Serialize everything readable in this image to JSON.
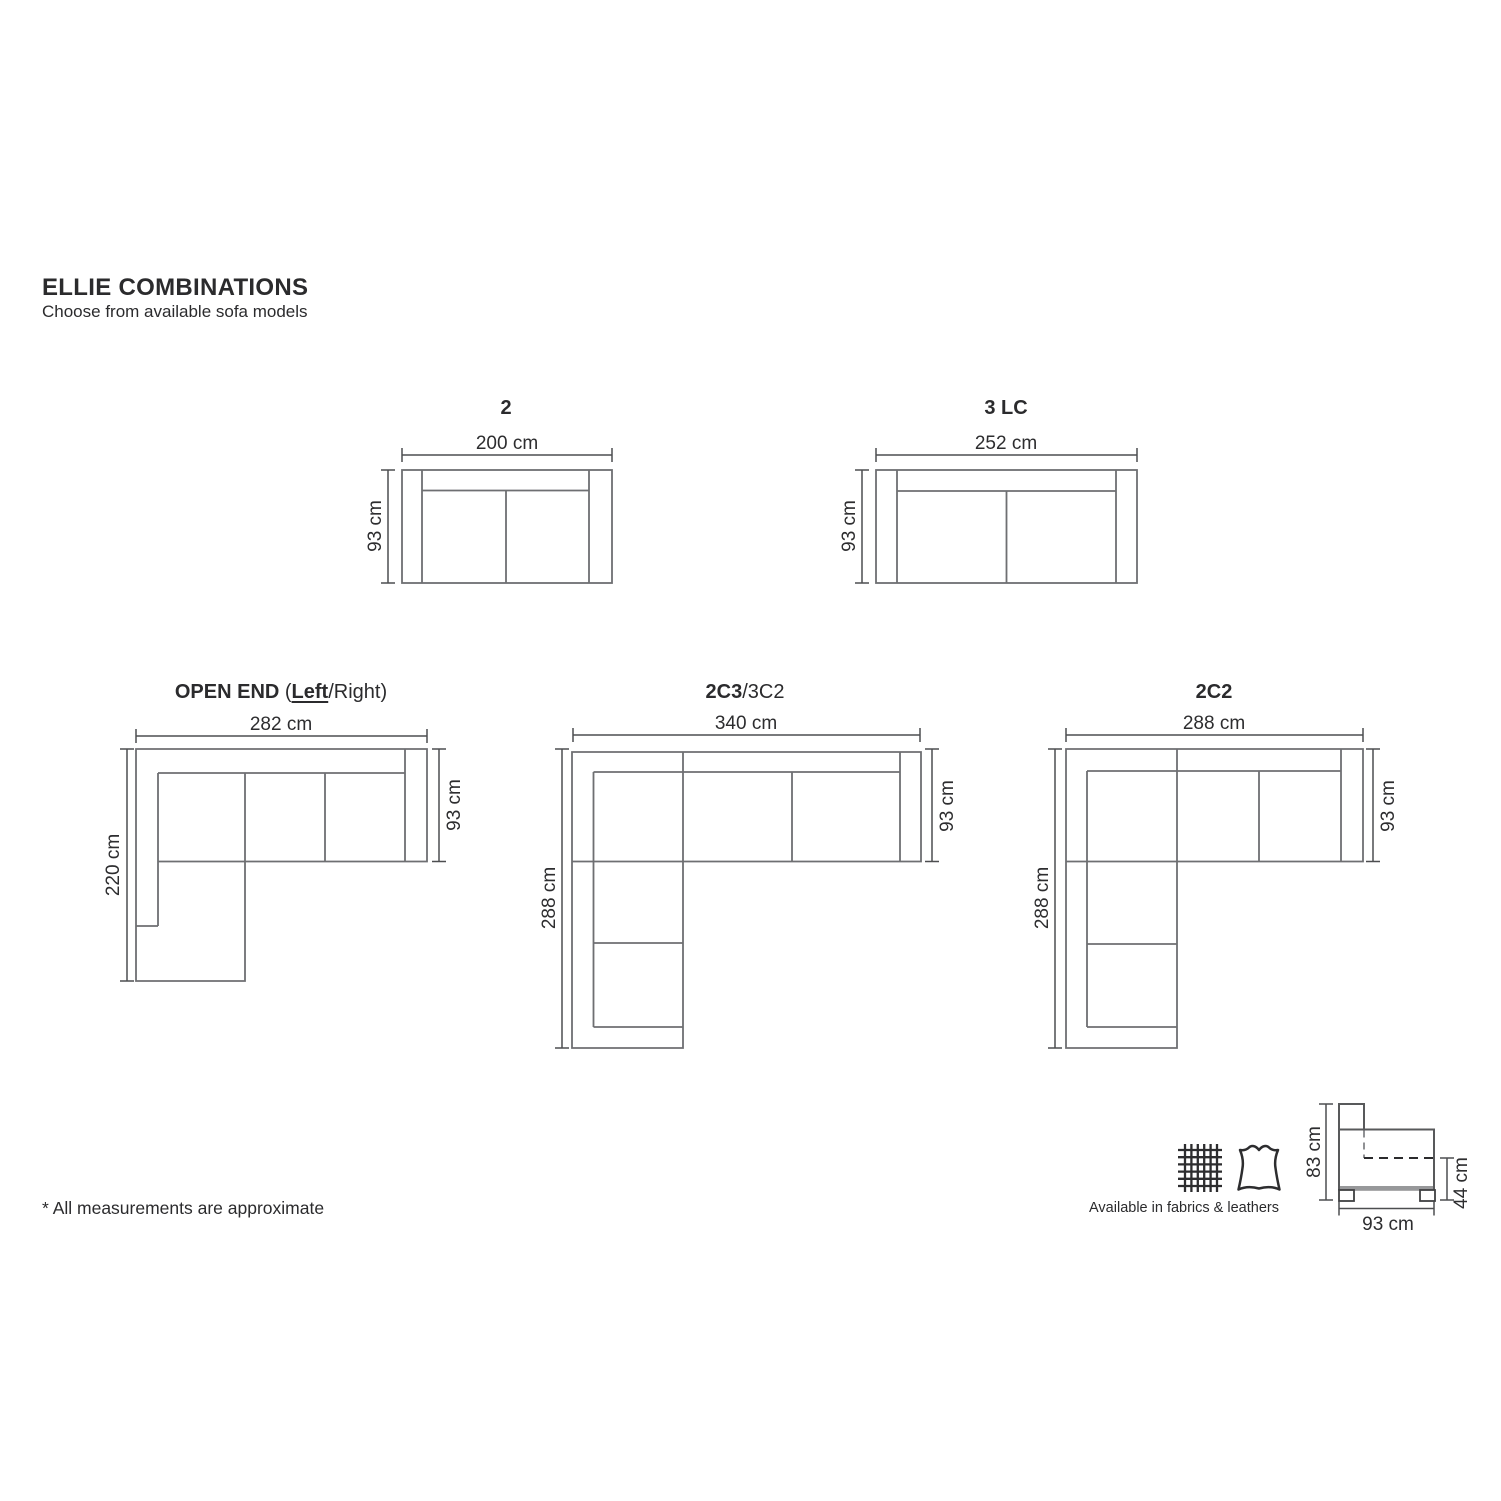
{
  "header": {
    "title": "ELLIE COMBINATIONS",
    "subtitle": "Choose from available sofa models"
  },
  "models": {
    "m2": {
      "name": "2",
      "width": "200 cm",
      "depth": "93 cm"
    },
    "m3lc": {
      "name": "3 LC",
      "width": "252 cm",
      "depth": "93 cm"
    },
    "open_end": {
      "name_bold": "OPEN END",
      "paren": " (",
      "left_bold": "Left",
      "name_rest": "/Right)",
      "width": "282 cm",
      "length": "220 cm",
      "depth": "93 cm"
    },
    "m2c3": {
      "name_bold": "2C3",
      "name_rest": "/3C2",
      "width": "340 cm",
      "length": "288 cm",
      "depth": "93 cm"
    },
    "m2c2": {
      "name": "2C2",
      "width": "288 cm",
      "length": "288 cm",
      "depth": "93 cm"
    }
  },
  "footnote": "* All measurements are approximate",
  "availability": {
    "label": "Available in fabrics & leathers",
    "icons": [
      "fabric-swatch-icon",
      "leather-hide-icon"
    ]
  },
  "side_view": {
    "height": "83 cm",
    "seat_height": "44 cm",
    "depth": "93 cm"
  },
  "colors": {
    "furniture_line": "#6e6f72",
    "dimension_line": "#4d4e50",
    "text": "#2d2d2f",
    "background": "#ffffff"
  }
}
